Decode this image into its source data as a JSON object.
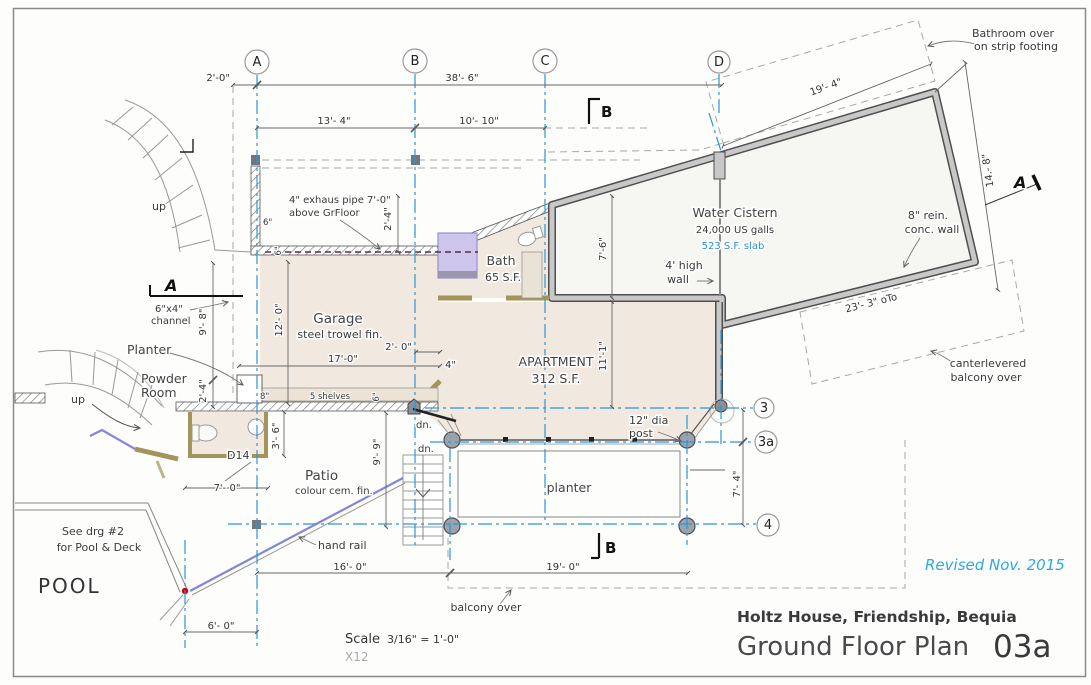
{
  "titleblock": {
    "revised": "Revised   Nov. 2015",
    "project": "Holtz House,  Friendship,  Bequia",
    "sheet_title": "Ground Floor Plan",
    "sheet_number": "03a",
    "scale_word": "Scale",
    "scale_value": "3/16\" = 1'-0\"",
    "watermark": "X12"
  },
  "grid": {
    "a": "A",
    "b": "B",
    "c": "C",
    "d": "D",
    "r3": "3",
    "r3a": "3a",
    "r4": "4"
  },
  "sections": {
    "a_left": "A",
    "a_right": "A",
    "b_top": "B",
    "b_bottom": "B"
  },
  "rooms": {
    "garage_name": "Garage",
    "garage_finish": "steel trowel fin.",
    "apartment_name": "APARTMENT",
    "apartment_area": "312 S.F.",
    "bath_name": "Bath",
    "bath_area": "65 S.F.",
    "powder_1": "Powder",
    "powder_2": "Room",
    "patio_name": "Patio",
    "patio_finish": "colour cem. fin.",
    "pool": "POOL",
    "cistern_name": "Water Cistern",
    "cistern_capacity": "24,000 US galls",
    "cistern_slab": "523 S.F. slab",
    "planter_upper": "Planter",
    "planter_lower": "planter"
  },
  "notes": {
    "bathroom_over_1": "Bathroom over",
    "bathroom_over_2": "on strip footing",
    "rein_wall_1": "8\" rein.",
    "rein_wall_2": "conc. wall",
    "high_wall_1": "4' high",
    "high_wall_2": "wall",
    "cantilever_1": "canterlevered",
    "cantilever_2": "balcony over",
    "exhaust_1": "4\" exhaus pipe 7'-0\"",
    "exhaust_2": "above GrFloor",
    "channel_1": "6\"x4\"",
    "channel_2": "channel",
    "shelves": "5 shelves",
    "door_d14": "D14",
    "post_1": "12\" dia",
    "post_2": "post",
    "handrail": "hand rail",
    "see_drg_1": "See drg #2",
    "see_drg_2": "for Pool & Deck",
    "balcony_over": "balcony over",
    "up_top": "up",
    "up_bottom": "up",
    "dn_1": "dn.",
    "dn_2": "dn."
  },
  "dims": {
    "d2_0": "2'-0\"",
    "d38_6": "38'- 6\"",
    "d13_4": "13'- 4\"",
    "d10_10": "10'- 10\"",
    "d19_4": "19'- 4\"",
    "d14_8": "14.- 8\"",
    "d23_3": "23'- 3\" oTo",
    "d7_6": "7'-6\"",
    "d11_1": "11'-1\"",
    "d12_0": "12'- 0\"",
    "d9_8": "9'- 8\"",
    "d2_4_left": "2'-4\"",
    "d2_4_pipe": "2'-4\"",
    "d17_0": "17'-0\"",
    "d2_0_garage": "2'- 0\"",
    "d4_wall": "4\"",
    "d8_wall": "8\"",
    "d6_wall_a": "6\"",
    "d6_wall_b": "6\"",
    "d6_shelf": "6\"",
    "d3_6": "3'- 6\"",
    "d9_9": "9'- 9\"",
    "d7_0": "7'- 0\"",
    "d7_4": "7'- 4\"",
    "d16_0": "16'- 0\"",
    "d19_0": "19'- 0\"",
    "d6_0": "6'- 0\""
  },
  "colors": {
    "grid_blue": "#2e96d6",
    "revised_blue": "#2aa9e1",
    "slab_blue": "#2f8fd0",
    "floor_beige": "#f1e9e0",
    "wall_gray": "#c8c8c8",
    "wall_khaki": "#a3945a",
    "shower_purple": "#cdc5ec",
    "handrail_purple": "#8585d8",
    "marker_red": "#d40000"
  }
}
